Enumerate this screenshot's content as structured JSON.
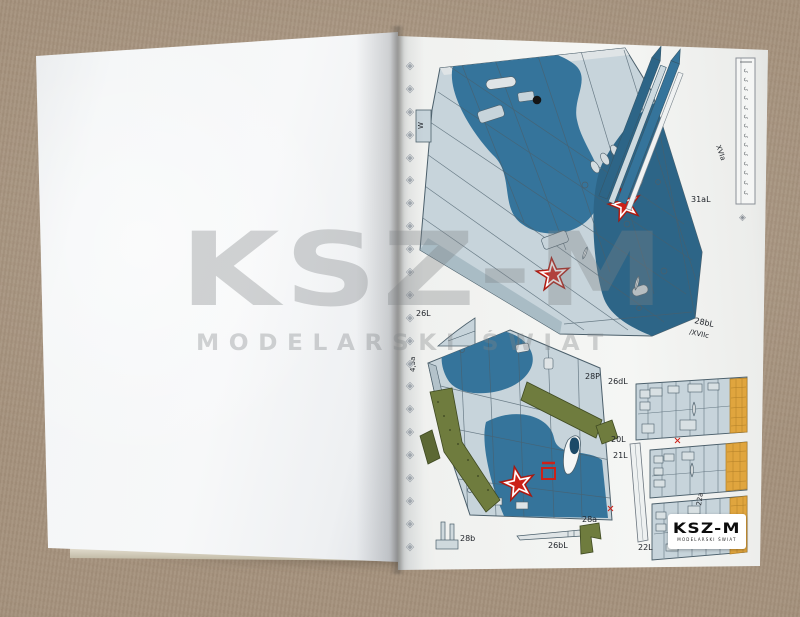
{
  "photo": {
    "watermark": {
      "title": "KSZ-M",
      "subtitle": "MODELARSKI ŚWIAT"
    },
    "logo": {
      "title": "KSZ-M",
      "subtitle": "MODELARSKI ŚWIAT"
    }
  },
  "sheet": {
    "ornament_glyph": "◈",
    "ruler_mark": "ς",
    "labels": {
      "w_mark": "W",
      "xvia": "XVIa",
      "p31aL": "31aL",
      "p28bL": "28bL",
      "xviic": "/XVIIc",
      "p26L": "26L",
      "p45a": "4,5a",
      "p28P": "28P",
      "p26dL": "26dL",
      "p20L": "20L",
      "p21L": "21L",
      "p22a": "22a",
      "p22L": "22L",
      "p28b": "28b",
      "p26bL": "26bL",
      "p28a": "28a"
    },
    "colors": {
      "table": "#a6937e",
      "page": "#f3f4f3",
      "part_base": "#c7d4db",
      "part_pale": "#dfe4e6",
      "camo_blue": "#35749b",
      "camo_dark": "#2d6587",
      "olive": "#6f7c3e",
      "mustard": "#e0a53e",
      "star_red": "#cc2118",
      "line": "#4b5f6b",
      "watermark_grey": "#7f8386"
    }
  }
}
